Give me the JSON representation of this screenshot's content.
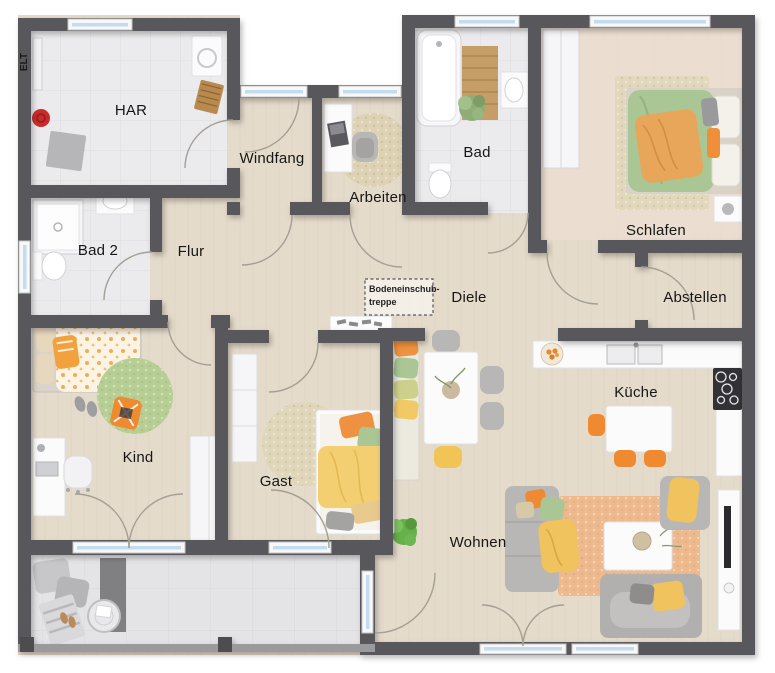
{
  "plan": {
    "rooms": {
      "elt": "ELT",
      "har": "HAR",
      "windfang": "Windfang",
      "arbeiten": "Arbeiten",
      "bad": "Bad",
      "schlafen": "Schlafen",
      "bad2": "Bad 2",
      "flur": "Flur",
      "diele": "Diele",
      "abstellen": "Abstellen",
      "kind": "Kind",
      "gast": "Gast",
      "kueche": "Küche",
      "wohnen": "Wohnen"
    },
    "annotations": {
      "attic_ladder_line1": "Bodeneinschub-",
      "attic_ladder_line2": "treppe"
    },
    "colors": {
      "wall": "#59595b",
      "wood_floor": "#e5dbcb",
      "wood_floor_light": "#ecdfd2",
      "tile_floor": "#ebebed",
      "terrace_floor": "#e4e4e6",
      "window_glass": "#c3ddee",
      "accent_orange": "#ee9140",
      "accent_green": "#a9c694",
      "accent_yellow": "#f2c967",
      "furniture_gray": "#b9b7b5",
      "rug_beige": "#e0d6ba",
      "rug_green": "#b7cf94",
      "rug_terracotta": "#eeba8d"
    }
  }
}
